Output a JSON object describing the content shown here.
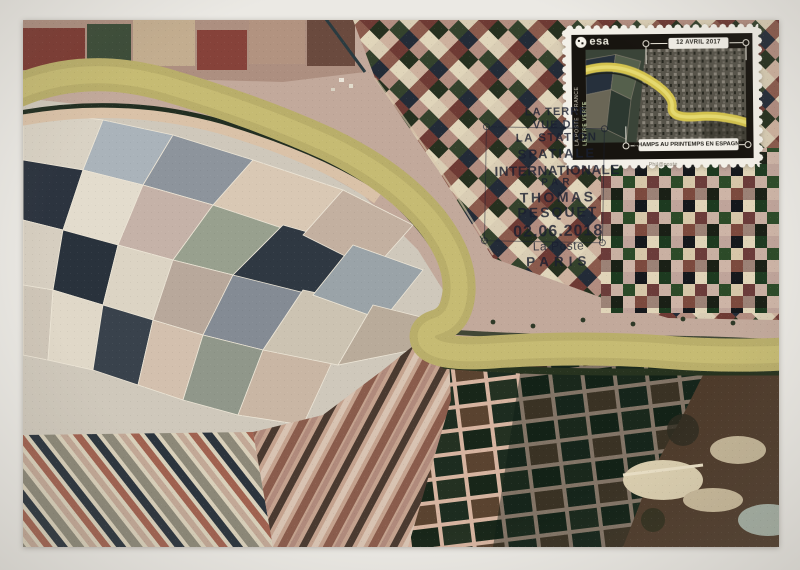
{
  "stamp": {
    "brand": "esa",
    "date_label": "12 AVRIL 2017",
    "caption": "CHAMPS AU PRINTEMPS EN ESPAGNE",
    "side_primary": "LA POSTE - FRANCE",
    "side_secondary": "LETTRE VERTE",
    "imprint": "Phil@poste",
    "colors": {
      "frame": "#17140f",
      "paper": "#f3f0e8",
      "river_band": "#d3c24e"
    }
  },
  "postmark": {
    "lines": [
      "LA TERRE",
      "VUE DE",
      "LA STATION",
      "SPATIALE",
      "INTERNATIONALE",
      "PAR",
      "THOMAS",
      "PESQUET",
      "02.06.2018",
      "La Poste",
      "PARIS"
    ],
    "ink_color": "#1a1f30"
  },
  "scene_colors": {
    "river": "#b9ae6a",
    "card_margin": "#ebe9e4",
    "field_pink": "#c79e90",
    "field_dark": "#26301f"
  },
  "icons": {
    "esa_globe": "esa-globe-logo",
    "pin": "measurement-pin"
  }
}
